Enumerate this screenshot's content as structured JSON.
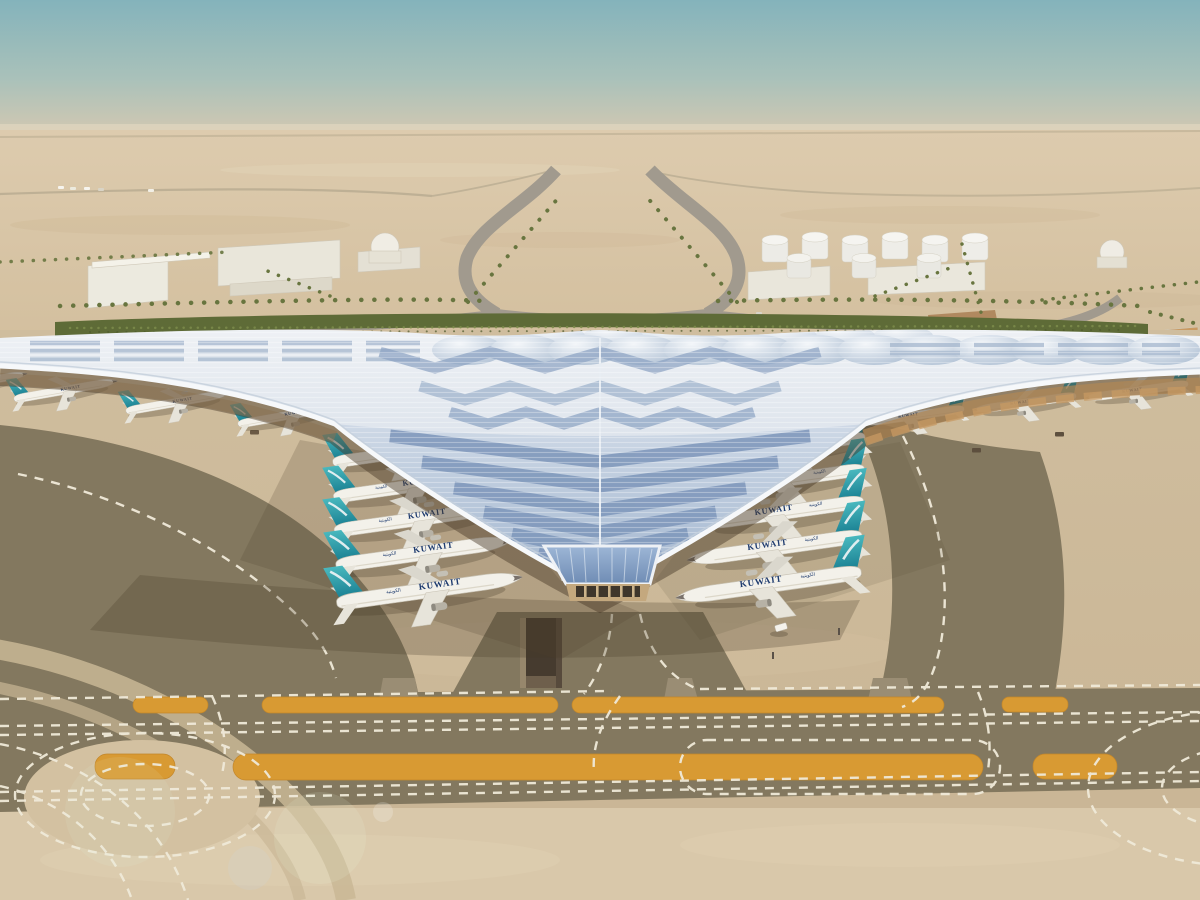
{
  "meta": {
    "description": "Aerial architectural rendering of a desert airport terminal with a sweeping trefoil roof, aircraft parked at gates, approach roads, palm-lined boulevard and marked taxiways"
  },
  "scene": {
    "airline_title": "KUWAIT",
    "airline_title_arabic": "الكويتية",
    "aircraft": {
      "left_gate_count": 5,
      "right_gate_count": 5,
      "left_pier_count": 4,
      "right_pier_count": 3,
      "tail_color": "#2f9fae",
      "fuselage_color": "#f3f1ea",
      "title_color": "#1d3a6e"
    },
    "terminal": {
      "roof_color": "#dfe6ee",
      "glazing_color": "#8fa9cb",
      "eave_color": "#f6f8fa",
      "underside_color": "#b08755"
    },
    "ground": {
      "apron_color": "#cdbb9c",
      "taxiway_color": "#83785f",
      "marking_color": "#f0ead9",
      "painted_island_color": "#d89a33",
      "sand_color": "#d9c8aa"
    },
    "sky": {
      "top_color": "#84b3bb",
      "horizon_color": "#d8c9b0"
    },
    "landscape": {
      "hedge_color": "#5e6b37",
      "palm_color": "#68753f"
    },
    "background": {
      "building_color": "#eae7dc",
      "tank_count": 9,
      "dome_count": 2
    }
  }
}
